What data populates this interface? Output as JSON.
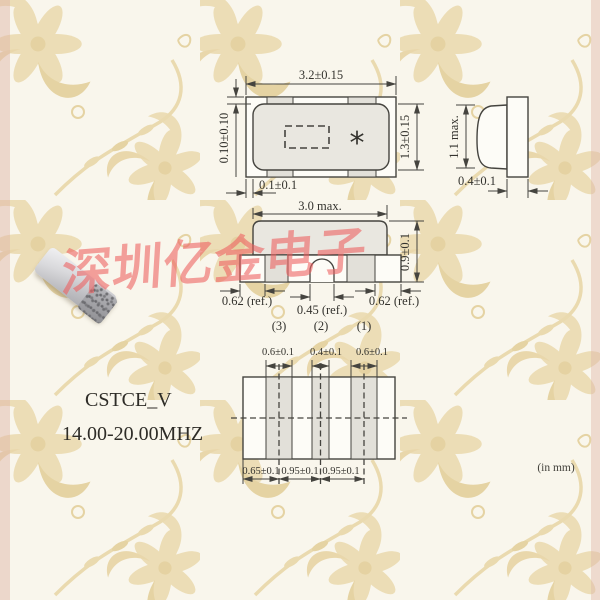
{
  "watermark": {
    "text": "深圳亿金电子",
    "color": "#ee5f5f"
  },
  "product": {
    "series": "CSTCE_V",
    "freq_range": "14.00-20.00MHZ"
  },
  "units_note": "(in mm)",
  "colors": {
    "line": "#45443f",
    "body_fill": "#e9e7e0",
    "pad_fill": "#e2e0d9",
    "paper": "#f9f6ec",
    "motif": "#ead9ac"
  },
  "views": {
    "top": {
      "dim_width": "3.2±0.15",
      "dim_height": "1.3±0.15",
      "dim_lid_offset": "0.10±0.10",
      "dim_end_offset": "0.1±0.1",
      "marking": "*"
    },
    "side": {
      "dim_height": "1.1 max.",
      "dim_terminal_width": "0.4±0.1"
    },
    "front": {
      "dim_width": "3.0 max.",
      "dim_height": "0.9±0.1",
      "dim_outer_left": "0.62 (ref.)",
      "dim_center": "0.45 (ref.)",
      "dim_outer_right": "0.62 (ref.)",
      "pins": [
        "(3)",
        "(2)",
        "(1)"
      ]
    },
    "footprint": {
      "dims_pad_width": [
        "0.6±0.1",
        "0.4±0.1",
        "0.6±0.1"
      ],
      "dims_pitch": [
        "0.65±0.1",
        "0.95±0.1",
        "0.95±0.1"
      ]
    }
  }
}
